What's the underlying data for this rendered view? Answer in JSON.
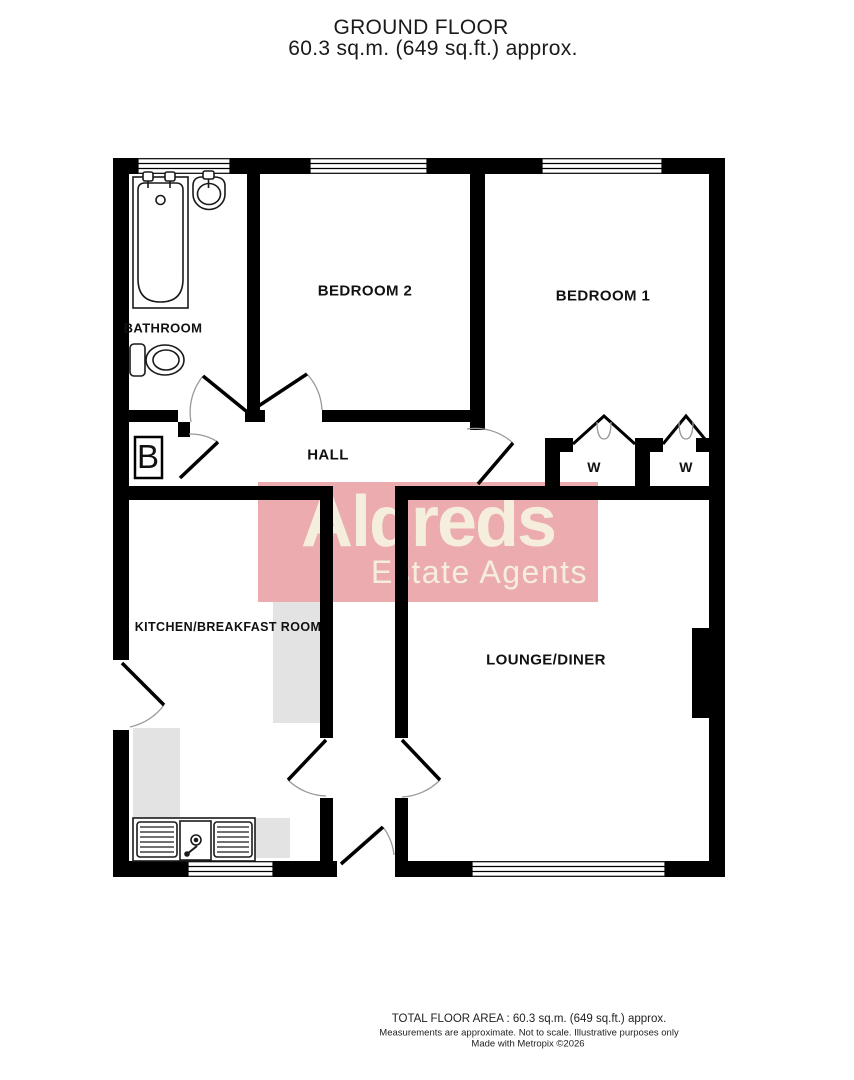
{
  "title": {
    "line1": "GROUND FLOOR",
    "line2": "60.3 sq.m. (649 sq.ft.) approx."
  },
  "rooms": {
    "bathroom": "BATHROOM",
    "bedroom2": "BEDROOM 2",
    "bedroom1": "BEDROOM 1",
    "hall": "HALL",
    "kitchen": "KITCHEN/BREAKFAST ROOM",
    "lounge": "LOUNGE/DINER",
    "wardrobe1": "W",
    "wardrobe2": "W",
    "boiler": "B"
  },
  "watermark": {
    "name": "Aldreds",
    "tagline": "Estate Agents",
    "bg_color": "#ecabaf",
    "text_color": "#f5eedd",
    "gray_color": "#e3e3e3"
  },
  "footer": {
    "line1": "TOTAL FLOOR AREA : 60.3 sq.m. (649 sq.ft.) approx.",
    "line2": "Measurements are approximate.  Not to scale.  Illustrative purposes only",
    "line3": "Made with Metropix ©2026"
  },
  "colors": {
    "wall": "#000000",
    "fixture_outline": "#1a1a1a",
    "door_arc": "#999999",
    "text": "#111111"
  }
}
